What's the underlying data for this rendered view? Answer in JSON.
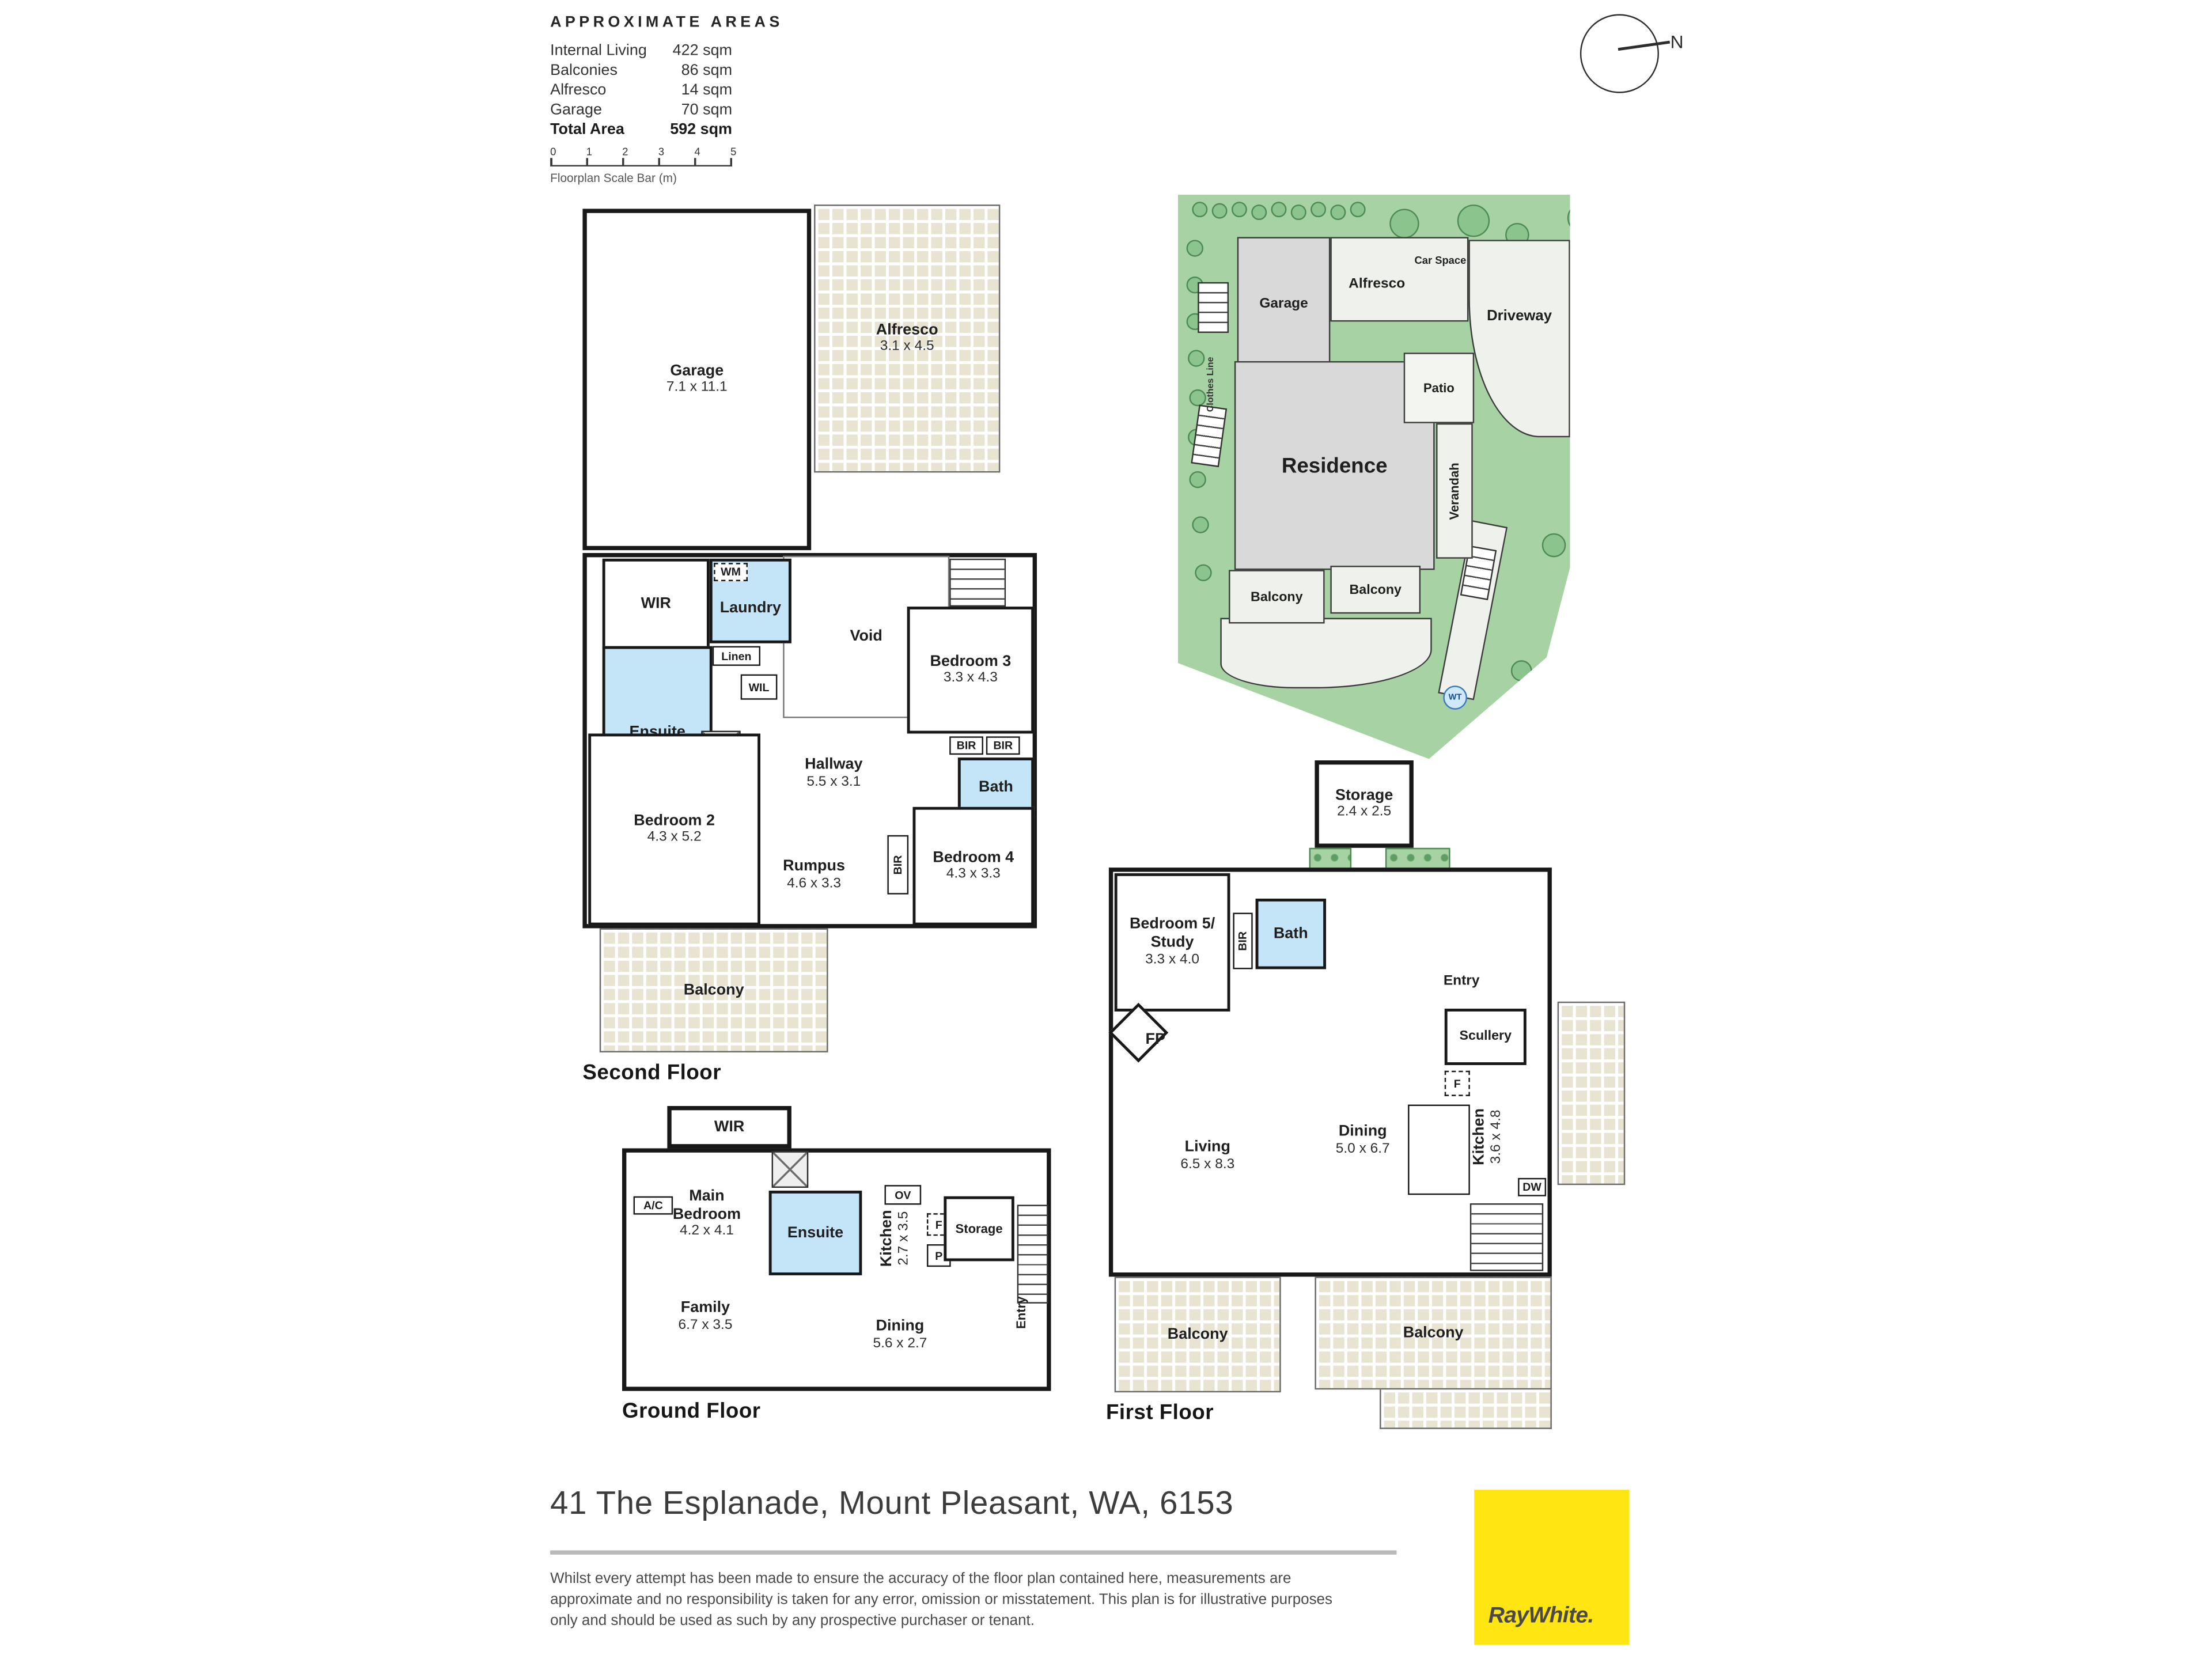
{
  "areas_panel": {
    "title": "APPROXIMATE AREAS",
    "rows": [
      {
        "label": "Internal Living",
        "value": "422 sqm"
      },
      {
        "label": "Balconies",
        "value": "86 sqm"
      },
      {
        "label": "Alfresco",
        "value": "14 sqm"
      },
      {
        "label": "Garage",
        "value": "70 sqm"
      }
    ],
    "total": {
      "label": "Total Area",
      "value": "592 sqm"
    },
    "scale_bar": {
      "ticks": [
        "0",
        "1",
        "2",
        "3",
        "4",
        "5"
      ],
      "caption": "Floorplan Scale Bar (m)"
    }
  },
  "compass": {
    "north_label": "N"
  },
  "second_floor": {
    "floor_label": "Second Floor",
    "garage": {
      "name": "Garage",
      "dims": "7.1 x 11.1"
    },
    "alfresco": {
      "name": "Alfresco",
      "dims": "3.1 x 4.5"
    },
    "wir": "WIR",
    "wm": "WM",
    "laundry": "Laundry",
    "linen": "Linen",
    "wil": "WIL",
    "ensuite": "Ensuite",
    "void": "Void",
    "bedroom3": {
      "name": "Bedroom 3",
      "dims": "3.3 x 4.3"
    },
    "bir1": "BIR",
    "bir2": "BIR",
    "bath": "Bath",
    "hallway": {
      "name": "Hallway",
      "dims": "5.5 x 3.1"
    },
    "bedroom2": {
      "name": "Bedroom 2",
      "dims": "4.3 x 5.2"
    },
    "rumpus": {
      "name": "Rumpus",
      "dims": "4.6 x 3.3"
    },
    "bir3": "BIR",
    "bedroom4": {
      "name": "Bedroom 4",
      "dims": "4.3 x 3.3"
    },
    "balcony": "Balcony"
  },
  "site_plan": {
    "garage": "Garage",
    "alfresco": "Alfresco",
    "car_space": "Car Space",
    "driveway": "Driveway",
    "patio": "Patio",
    "residence": "Residence",
    "verandah": "Verandah",
    "balcony1": "Balcony",
    "balcony2": "Balcony",
    "clothes_line": "Clothes Line",
    "water_tank": "WT"
  },
  "first_floor": {
    "floor_label": "First Floor",
    "storage": {
      "name": "Storage",
      "dims": "2.4 x 2.5"
    },
    "entry": "Entry",
    "bedroom5": {
      "name": "Bedroom 5/",
      "name2": "Study",
      "dims": "3.3 x 4.0"
    },
    "bir": "BIR",
    "bath": "Bath",
    "fp": "FP",
    "living": {
      "name": "Living",
      "dims": "6.5 x 8.3"
    },
    "dining": {
      "name": "Dining",
      "dims": "5.0 x 6.7"
    },
    "scullery": "Scullery",
    "fridge": "F",
    "kitchen": {
      "name": "Kitchen",
      "dims": "3.6 x 4.8"
    },
    "dw": "DW",
    "balcony1": "Balcony",
    "balcony2": "Balcony"
  },
  "ground_floor": {
    "floor_label": "Ground Floor",
    "wir": "WIR",
    "ac": "A/C",
    "main_bedroom": {
      "name": "Main",
      "name2": "Bedroom",
      "dims": "4.2 x 4.1"
    },
    "ensuite": "Ensuite",
    "ov": "OV",
    "kitchen": {
      "name": "Kitchen",
      "dims": "2.7 x 3.5"
    },
    "fridge": "F",
    "pantry": "P",
    "storage": "Storage",
    "family": {
      "name": "Family",
      "dims": "6.7 x 3.5"
    },
    "dining": {
      "name": "Dining",
      "dims": "5.6 x 2.7"
    },
    "entry": "Entry"
  },
  "footer": {
    "address": "41 The Esplanade, Mount Pleasant, WA, 6153",
    "disclaimer": "Whilst every attempt has been made to ensure the accuracy of the floor plan contained here, measurements are approximate and no responsibility is taken for any error, omission or misstatement. This plan is for illustrative purposes only and should be used as such by any prospective purchaser or tenant.",
    "brand": "RayWhite."
  },
  "colors": {
    "brand_yellow": "#FFE512",
    "wet_area_blue": "#C3E5F7",
    "lawn_green": "#A7D2A3",
    "tile_beige": "#E9E4D2",
    "wall_black": "#181818"
  }
}
